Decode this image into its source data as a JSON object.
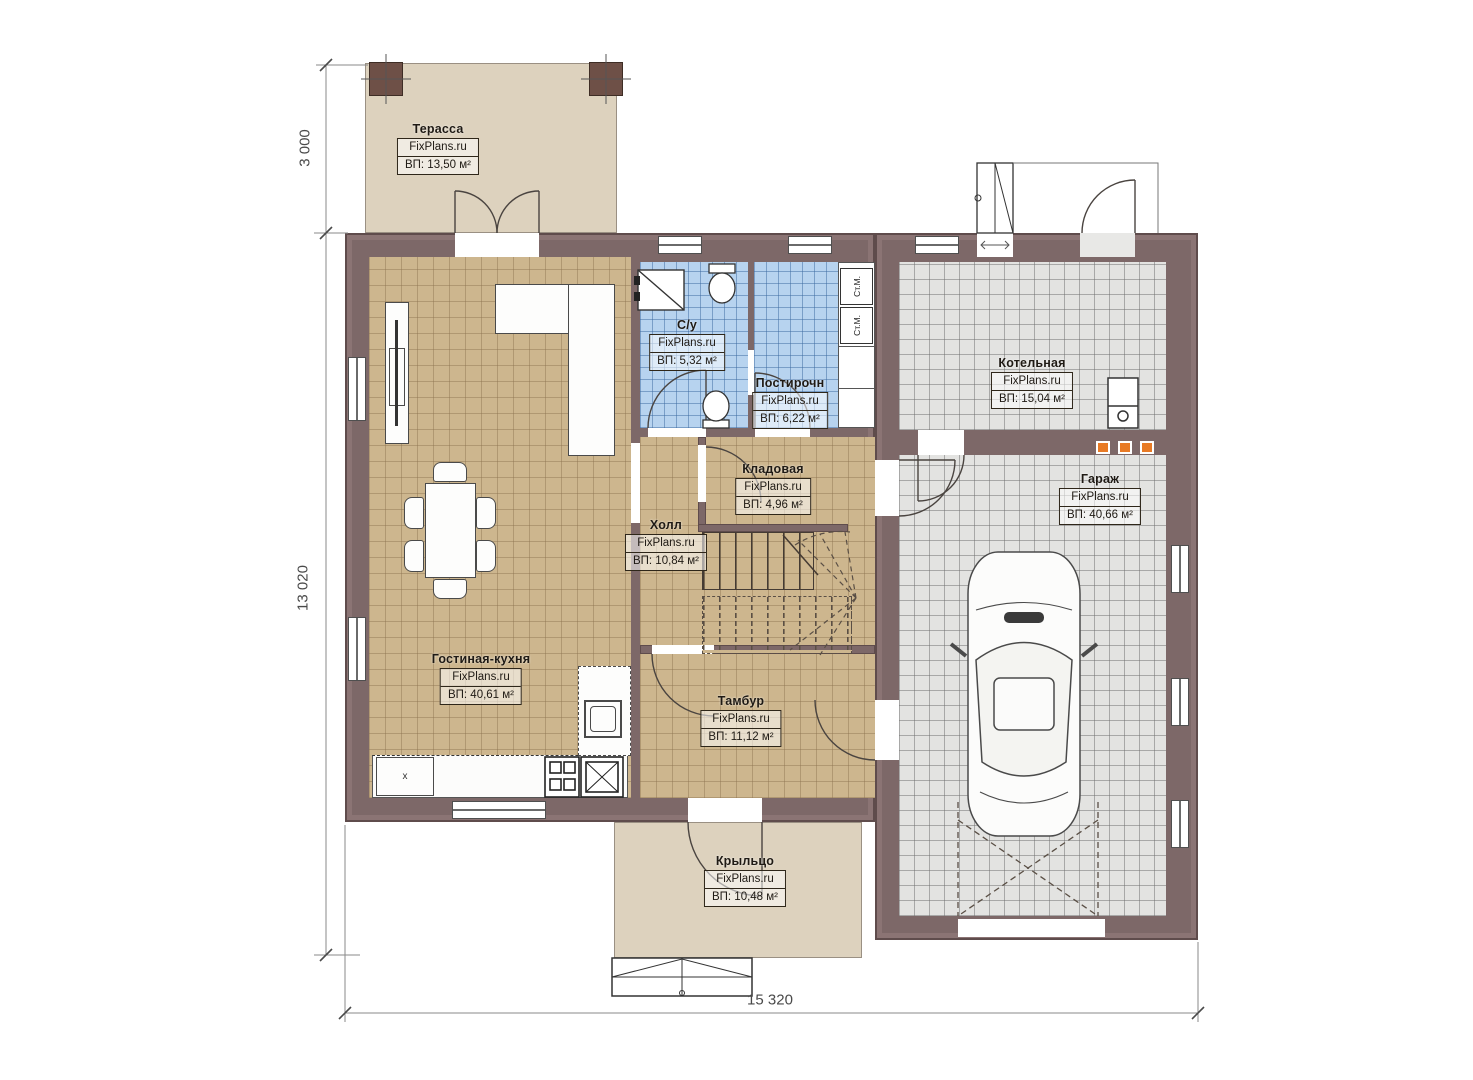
{
  "plan": {
    "brand": "FixPlans.ru",
    "rooms": {
      "terrace": {
        "name": "Терасса",
        "brand": "FixPlans.ru",
        "area": "ВП: 13,50 м²"
      },
      "living_kitchen": {
        "name": "Гостиная-кухня",
        "brand": "FixPlans.ru",
        "area": "ВП: 40,61 м²"
      },
      "bathroom": {
        "name": "С/у",
        "brand": "FixPlans.ru",
        "area": "ВП: 5,32 м²"
      },
      "laundry": {
        "name": "Постирочн",
        "brand": "FixPlans.ru",
        "area": "ВП: 6,22 м²"
      },
      "boiler": {
        "name": "Котельная",
        "brand": "FixPlans.ru",
        "area": "ВП: 15,04 м²"
      },
      "storage": {
        "name": "Кладовая",
        "brand": "FixPlans.ru",
        "area": "ВП: 4,96 м²"
      },
      "hall": {
        "name": "Холл",
        "brand": "FixPlans.ru",
        "area": "ВП: 10,84 м²"
      },
      "garage": {
        "name": "Гараж",
        "brand": "FixPlans.ru",
        "area": "ВП: 40,66 м²"
      },
      "vestibule": {
        "name": "Тамбур",
        "brand": "FixPlans.ru",
        "area": "ВП: 11,12 м²"
      },
      "porch": {
        "name": "Крыльцо",
        "brand": "FixPlans.ru",
        "area": "ВП: 10,48 м²"
      }
    },
    "dimensions": {
      "terrace_depth": "3 000",
      "total_depth": "13 020",
      "total_width": "15 320"
    },
    "appliances": {
      "washer_label": "Ст.М."
    },
    "marks": {
      "kitchen_unit": "x"
    },
    "colors": {
      "wall": "#7d6868",
      "tan_floor": "#cdb68e",
      "blue_floor": "#b7d3ef",
      "gray_floor": "#e3e3e1",
      "outdoor": "#ddd2be",
      "accent_orange": "#e87a25"
    }
  }
}
